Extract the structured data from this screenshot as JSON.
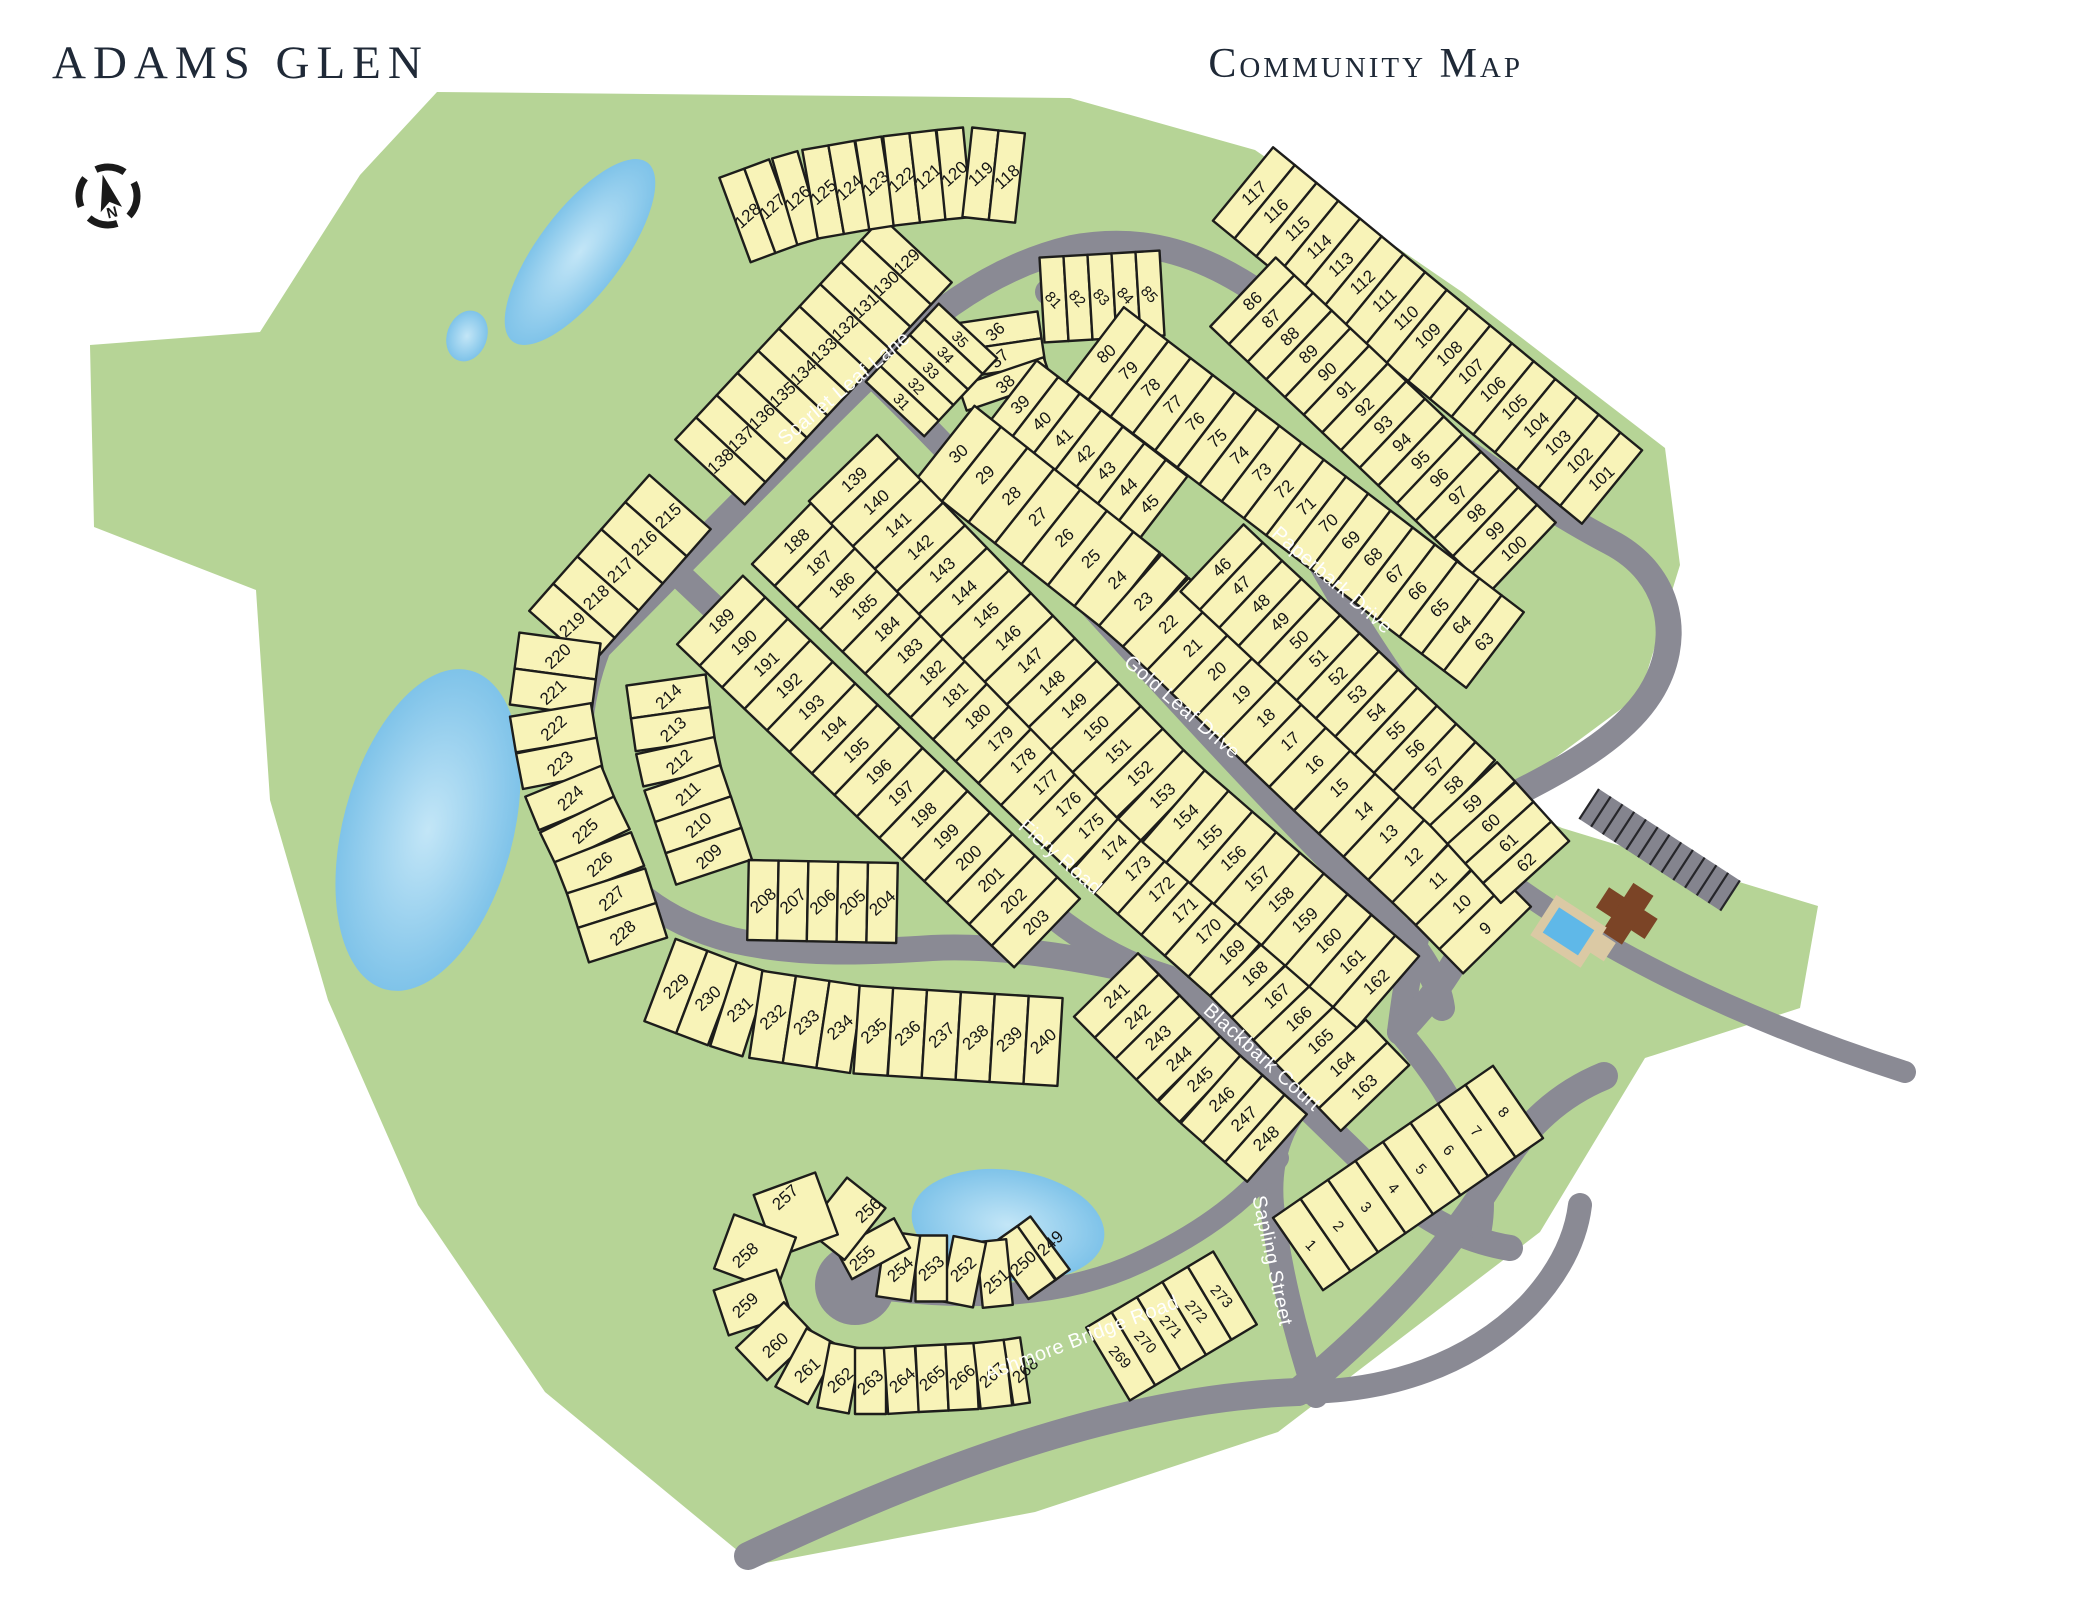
{
  "header": {
    "title": "ADAMS GLEN",
    "subtitle": "Community Map"
  },
  "compass": {
    "label": "N",
    "cx": 108,
    "cy": 196,
    "r": 29
  },
  "colors": {
    "green": "#b6d496",
    "pond": "#7fc3e9",
    "pond_hi": "#c3e6f7",
    "road": "#8a8a94",
    "lot_fill": "#f8f3b8",
    "lot_stroke": "#1d1d1b",
    "number": "#151515",
    "street_text": "#ffffff",
    "title": "#1f2937",
    "clubhouse": "#7b4426",
    "deck": "#dbc9a4",
    "pool": "#5fb8e8",
    "parking": "#84848e"
  },
  "map": {
    "boundary": [
      [
        437,
        92
      ],
      [
        1070,
        98
      ],
      [
        1255,
        150
      ],
      [
        1462,
        292
      ],
      [
        1665,
        448
      ],
      [
        1680,
        565
      ],
      [
        1640,
        695
      ],
      [
        1498,
        800
      ],
      [
        1562,
        828
      ],
      [
        1818,
        906
      ],
      [
        1800,
        1008
      ],
      [
        1645,
        1058
      ],
      [
        1540,
        1232
      ],
      [
        1278,
        1432
      ],
      [
        1035,
        1512
      ],
      [
        755,
        1565
      ],
      [
        545,
        1392
      ],
      [
        418,
        1205
      ],
      [
        328,
        1000
      ],
      [
        270,
        800
      ],
      [
        256,
        590
      ],
      [
        94,
        527
      ],
      [
        90,
        345
      ],
      [
        260,
        332
      ],
      [
        360,
        175
      ]
    ],
    "ponds": [
      {
        "name": "pond-north",
        "cx": 580,
        "cy": 252,
        "rx": 42,
        "ry": 112,
        "rot": 37
      },
      {
        "name": "pond-small-west",
        "cx": 467,
        "cy": 336,
        "rx": 20,
        "ry": 26,
        "rot": 20
      },
      {
        "name": "pond-west",
        "cx": 428,
        "cy": 830,
        "rx": 85,
        "ry": 165,
        "rot": 15
      },
      {
        "name": "pond-south",
        "cx": 1008,
        "cy": 1225,
        "rx": 97,
        "ry": 55,
        "rot": 8
      }
    ],
    "roads": [
      {
        "name": "scarlet-paperbark-outer",
        "w": 26,
        "d": "M 598,648 C 700,545 812,430 893,352 C 952,296 1012,262 1072,248 C 1185,227 1258,287 1348,362 C 1440,438 1545,508 1610,542 C 1672,574 1684,640 1650,694 C 1618,744 1550,776 1492,806 C 1452,826 1430,880 1418,930 C 1408,972 1404,1000 1400,1032"
      },
      {
        "name": "paperbark-inner",
        "w": 26,
        "d": "M 1048,292 C 1098,312 1135,334 1165,364 C 1235,434 1292,512 1332,582 C 1372,652 1422,722 1458,768 C 1486,804 1496,836 1490,868 C 1482,920 1452,980 1400,1032"
      },
      {
        "name": "gold-leaf-drive",
        "w": 26,
        "d": "M 880,382 C 960,460 1060,570 1160,680 C 1250,778 1330,862 1392,922 C 1420,950 1438,980 1442,1008"
      },
      {
        "name": "fiery-road-upper",
        "w": 26,
        "d": "M 672,568 C 790,680 920,800 1040,905 C 1090,948 1135,968 1168,978"
      },
      {
        "name": "fiery-road-loop",
        "w": 26,
        "d": "M 598,648 C 578,700 572,760 588,818 C 606,880 662,922 732,940 C 802,956 872,952 932,948 C 1010,944 1100,962 1168,978"
      },
      {
        "name": "blackbark-court",
        "w": 26,
        "d": "M 1168,978 C 1245,1045 1315,1115 1382,1180 C 1420,1218 1462,1240 1510,1248"
      },
      {
        "name": "j1-connector",
        "w": 24,
        "d": "M 1400,1032 C 1432,1070 1458,1108 1472,1148 C 1482,1178 1484,1205 1480,1228"
      },
      {
        "name": "sapling-street",
        "w": 24,
        "d": "M 1316,1396 C 1294,1330 1278,1262 1272,1205 C 1268,1158 1282,1115 1322,1080"
      },
      {
        "name": "ashmore-bridge-road",
        "w": 28,
        "d": "M 748,1556 C 930,1470 1120,1398 1298,1392"
      },
      {
        "name": "ashmore-ne",
        "w": 28,
        "d": "M 1298,1392 C 1372,1330 1444,1260 1498,1170 C 1526,1125 1560,1094 1604,1076"
      },
      {
        "name": "east-branch",
        "w": 24,
        "d": "M 1298,1392 C 1390,1392 1470,1364 1528,1306 C 1560,1272 1576,1238 1580,1205"
      },
      {
        "name": "amenity-road",
        "w": 22,
        "d": "M 1490,868 C 1600,952 1748,1022 1905,1072"
      },
      {
        "name": "culdesac-stub",
        "w": 22,
        "d": "M 872,1288 C 960,1300 1060,1300 1140,1262 C 1205,1232 1252,1195 1278,1158"
      }
    ],
    "culdesac": {
      "cx": 855,
      "cy": 1285,
      "r": 40
    },
    "lot_rows": [
      {
        "from": 129,
        "to": 138,
        "d": 95,
        "pts": [
          [
            917,
            250
          ],
          [
            710,
            472
          ]
        ]
      },
      {
        "from": 128,
        "to": 118,
        "d": 90,
        "pts": [
          [
            735,
            220
          ],
          [
            800,
            196
          ],
          [
            880,
            182
          ],
          [
            965,
            172
          ],
          [
            1020,
            178
          ]
        ]
      },
      {
        "from": 117,
        "to": 101,
        "d": 95,
        "pts": [
          [
            1243,
            184
          ],
          [
            1612,
            487
          ]
        ]
      },
      {
        "from": 81,
        "to": 85,
        "d": 85,
        "perp": true,
        "pts": [
          [
            1042,
            300
          ],
          [
            1162,
            293
          ]
        ]
      },
      {
        "from": 86,
        "to": 100,
        "d": 95,
        "pts": [
          [
            1243,
            292
          ],
          [
            1523,
            557
          ]
        ]
      },
      {
        "from": 36,
        "to": 45,
        "d": 90,
        "pts": [
          [
            993,
            318
          ],
          [
            1004,
            392
          ],
          [
            1160,
            512
          ]
        ]
      },
      {
        "from": 35,
        "to": 31,
        "d": 80,
        "perp": true,
        "pts": [
          [
            968,
            331
          ],
          [
            895,
            409
          ]
        ]
      },
      {
        "from": 30,
        "to": 9,
        "d": 95,
        "pts": [
          [
            945,
            443
          ],
          [
            1143,
            600
          ],
          [
            1318,
            768
          ],
          [
            1440,
            882
          ],
          [
            1497,
            940
          ]
        ]
      },
      {
        "from": 46,
        "to": 62,
        "d": 92,
        "pts": [
          [
            1212,
            558
          ],
          [
            1468,
            798
          ],
          [
            1535,
            872
          ]
        ]
      },
      {
        "from": 80,
        "to": 63,
        "d": 95,
        "pts": [
          [
            1095,
            345
          ],
          [
            1495,
            650
          ]
        ]
      },
      {
        "from": 188,
        "to": 163,
        "d": 95,
        "pts": [
          [
            785,
            530
          ],
          [
            1097,
            832
          ],
          [
            1250,
            968
          ],
          [
            1375,
            1098
          ]
        ]
      },
      {
        "from": 139,
        "to": 162,
        "d": 95,
        "pts": [
          [
            843,
            468
          ],
          [
            1163,
            797
          ],
          [
            1388,
            992
          ]
        ]
      },
      {
        "from": 189,
        "to": 203,
        "d": 95,
        "pts": [
          [
            710,
            610
          ],
          [
            1047,
            933
          ]
        ]
      },
      {
        "from": 214,
        "to": 209,
        "d": 80,
        "pts": [
          [
            666,
            680
          ],
          [
            678,
            765
          ],
          [
            700,
            830
          ],
          [
            714,
            872
          ]
        ]
      },
      {
        "from": 208,
        "to": 204,
        "d": 80,
        "pts": [
          [
            748,
            900
          ],
          [
            897,
            903
          ]
        ]
      },
      {
        "from": 215,
        "to": 228,
        "d": 82,
        "pts": [
          [
            680,
            502
          ],
          [
            560,
            638
          ],
          [
            550,
            713
          ],
          [
            565,
            790
          ],
          [
            600,
            862
          ],
          [
            628,
            950
          ]
        ]
      },
      {
        "from": 229,
        "to": 240,
        "d": 88,
        "pts": [
          [
            660,
            980
          ],
          [
            747,
            1013
          ],
          [
            860,
            1030
          ],
          [
            1060,
            1042
          ]
        ]
      },
      {
        "from": 241,
        "to": 248,
        "d": 90,
        "pts": [
          [
            1106,
            985
          ],
          [
            1200,
            1080
          ],
          [
            1277,
            1148
          ]
        ]
      },
      {
        "from": 249,
        "to": 268,
        "d": 66,
        "pts": [
          [
            1050,
            1243
          ],
          [
            1023,
            1263
          ],
          [
            996,
            1281
          ],
          [
            963,
            1269
          ],
          [
            931,
            1268
          ],
          [
            900,
            1269
          ],
          [
            862,
            1258
          ],
          [
            868,
            1210
          ],
          [
            785,
            1197
          ],
          [
            745,
            1255
          ],
          [
            745,
            1305
          ],
          [
            775,
            1345
          ],
          [
            807,
            1370
          ],
          [
            840,
            1380
          ],
          [
            870,
            1382
          ],
          [
            902,
            1380
          ],
          [
            932,
            1378
          ],
          [
            962,
            1377
          ],
          [
            992,
            1375
          ],
          [
            1025,
            1370
          ]
        ]
      },
      {
        "from": 269,
        "to": 273,
        "d": 85,
        "perp": true,
        "pts": [
          [
            1108,
            1364
          ],
          [
            1235,
            1288
          ]
        ]
      },
      {
        "from": 1,
        "to": 8,
        "d": 88,
        "perp": true,
        "pts": [
          [
            1298,
            1254
          ],
          [
            1518,
            1102
          ]
        ]
      }
    ],
    "street_labels": [
      {
        "name": "Scarlet Leaf Lane",
        "x": 848,
        "y": 393,
        "rot": -40
      },
      {
        "name": "Paperbark Drive",
        "x": 1328,
        "y": 585,
        "rot": 41
      },
      {
        "name": "Gold Leaf Drive",
        "x": 1178,
        "y": 712,
        "rot": 41
      },
      {
        "name": "Fiery Road",
        "x": 1056,
        "y": 862,
        "rot": 41
      },
      {
        "name": "Blackbark Court",
        "x": 1258,
        "y": 1062,
        "rot": 42
      },
      {
        "name": "Sapling Street",
        "x": 1266,
        "y": 1262,
        "rot": 78
      },
      {
        "name": "Ashmore Bridge Road",
        "x": 1084,
        "y": 1344,
        "rot": -21
      }
    ],
    "amenity": {
      "rot": 33,
      "ox": 1640,
      "oy": 880,
      "parking": {
        "x": 1556,
        "y": 826,
        "w": 168,
        "h": 36,
        "ticks": 12
      },
      "clubhouse": [
        {
          "x": 1618,
          "y": 903,
          "w": 58,
          "h": 24
        },
        {
          "x": 1636,
          "y": 886,
          "w": 24,
          "h": 58
        }
      ],
      "shed": {
        "x": 1624,
        "y": 946,
        "w": 30,
        "h": 22
      },
      "pool_deck": {
        "x": 1578,
        "y": 938,
        "w": 60,
        "h": 48
      },
      "pool": {
        "x": 1587,
        "y": 947,
        "w": 42,
        "h": 30
      }
    }
  }
}
